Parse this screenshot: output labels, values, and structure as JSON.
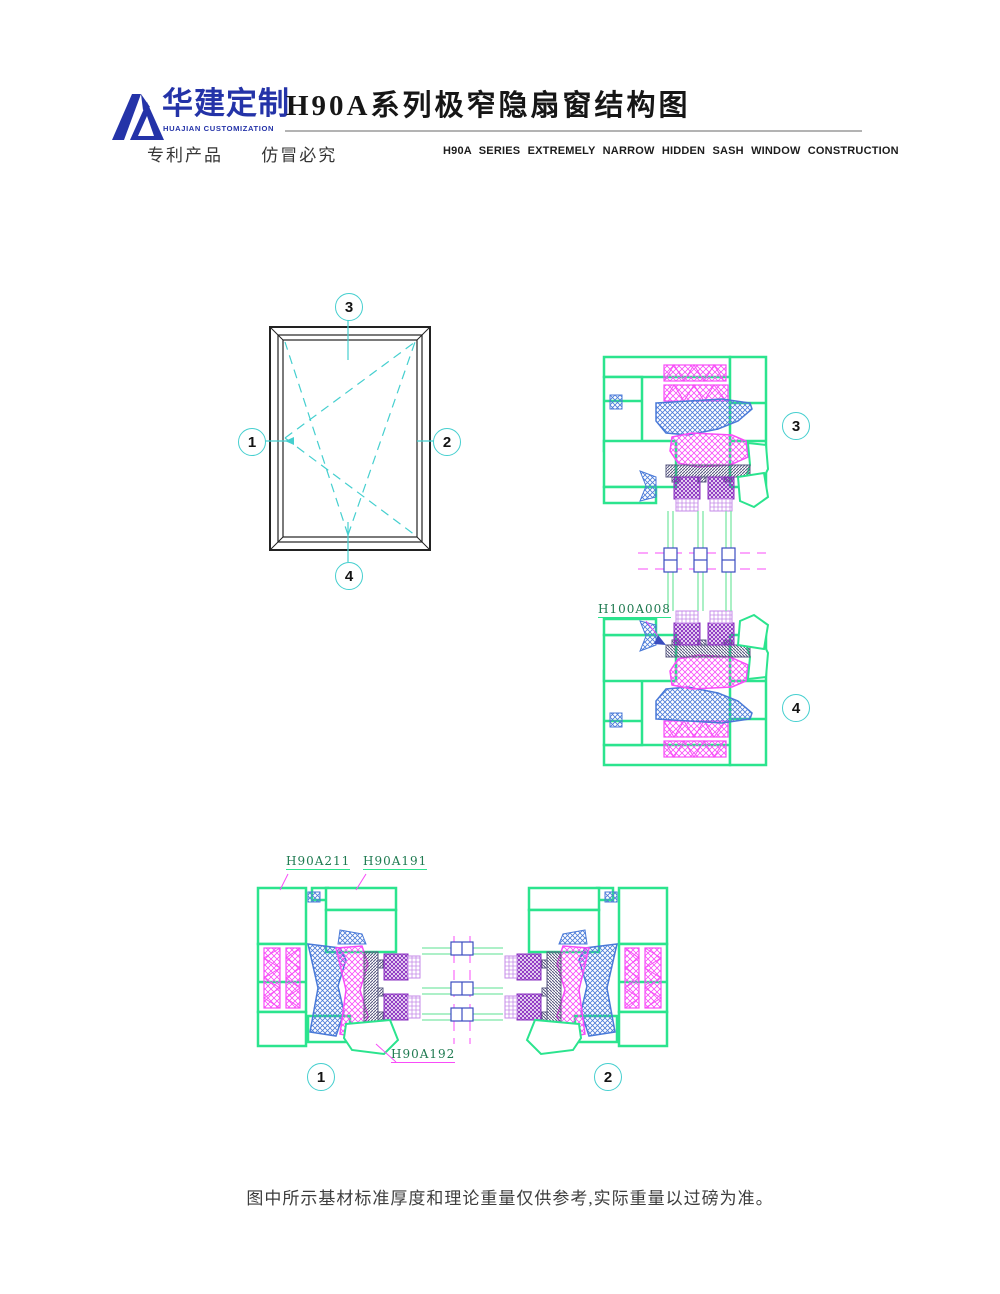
{
  "page": {
    "width_px": 1000,
    "height_px": 1294,
    "background": "#ffffff"
  },
  "header": {
    "brand_cn": "华建定制",
    "brand_en": "HUAJIAN CUSTOMIZATION",
    "title_cn": "H90A系列极窄隐扇窗结构图",
    "patent_left": "专利产品",
    "patent_right": "仿冒必究",
    "title_en": "H90A SERIES EXTREMELY NARROW HIDDEN SASH WINDOW CONSTRUCTION"
  },
  "elevation": {
    "description": "window elevation with tilt-turn opening symbol",
    "callout_left": "1",
    "callout_right": "2",
    "callout_top": "3",
    "callout_bottom": "4"
  },
  "vertical_section": {
    "description": "vertical cross-section through head and sill",
    "callout_top": "3",
    "callout_bottom": "4",
    "part_label": "H100A008"
  },
  "horizontal_section": {
    "description": "horizontal cross-section through jambs",
    "callout_left": "1",
    "callout_right": "2",
    "label_frame": "H90A211",
    "label_sash": "H90A191",
    "label_bead": "H90A192"
  },
  "footer": {
    "note": "图中所示基材标准厚度和理论重量仅供参考,实际重量以过磅为准。"
  },
  "icons": {
    "logo_mark": "huajian-mountain-logo"
  },
  "colors": {
    "brand_blue": "#2433a8",
    "callout_cyan": "#45cfcf",
    "profile_green": "#2be48e",
    "glass_green": "#7ce8a6",
    "seal_magenta": "#f84cf8",
    "hardware_blue": "#4a7ad8",
    "glazing_purple_dark": "#8a2fc0",
    "glazing_purple_light": "#c58ae8",
    "bridge_slate": "#5a5a82",
    "break_symbol_blue": "#3b4ec0",
    "title_black": "#161616",
    "label_green": "#1e7a50"
  }
}
